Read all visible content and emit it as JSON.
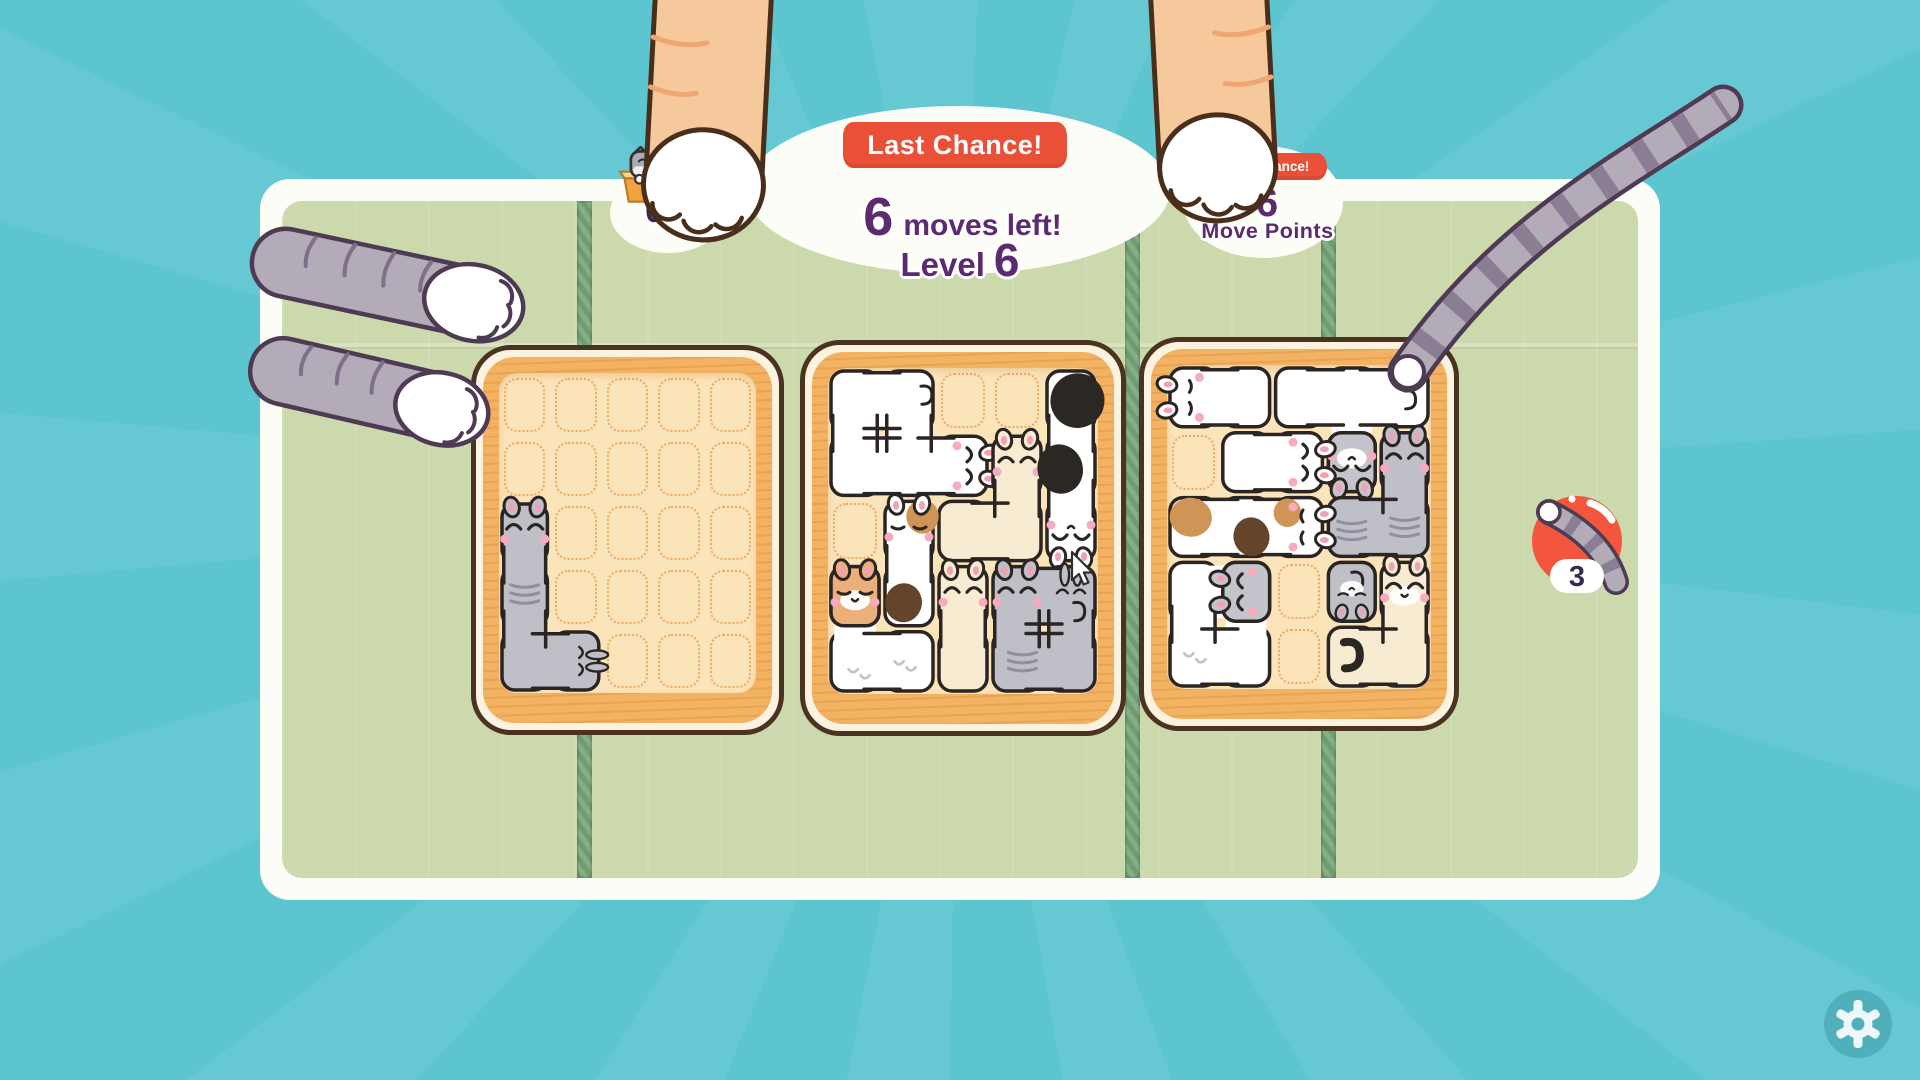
{
  "hud": {
    "boxed_cats": "0/4",
    "banner": "Last Chance!",
    "moves_number": "6",
    "moves_label": "moves left!",
    "level_label": "Level",
    "level_number": "6",
    "banner_right": "Last Chance!",
    "move_points_number": "6",
    "move_points_label": "Move Points",
    "booster_count": "3"
  },
  "palette": {
    "background_teal": "#5CC5CF",
    "panel_white": "#FDFDF7",
    "mat_green": "#CBD9AC",
    "seam_green": "#6F9C72",
    "basket_outline": "#4A3320",
    "basket_rim": "#F3B162",
    "basket_interior": "#FCE4BA",
    "grid_dots": "#ECA156",
    "ribbon_red": "#EA5038",
    "text_purple": "#5B2A70",
    "counter_navy": "#332C57",
    "ball_red": "#F2573D",
    "cat_gray": "#BFBFC7",
    "cat_cream": "#F7ECD2",
    "cat_white": "#FFFFFF",
    "cat_orange_head": "#EBAF79"
  },
  "board": {
    "grid": {
      "cols": 5,
      "rows": 5
    },
    "baskets": [
      {
        "name": "left",
        "x": 471,
        "y": 345,
        "w": 313,
        "h": 390,
        "pieces": [
          {
            "name": "gray-l-cat",
            "color": "gray",
            "cells": [
              [
                0,
                2
              ],
              [
                0,
                3
              ],
              [
                0,
                4
              ],
              [
                1,
                4
              ]
            ],
            "faces": [
              {
                "cell": [
                  0,
                  2
                ],
                "dir": "up",
                "style": "happy"
              },
              {
                "cell": [
                  1,
                  4
                ],
                "dir": "right",
                "style": "bunny",
                "small": true
              }
            ],
            "patches": [
              {
                "cell": [
                  0,
                  3
                ],
                "color": "stripes",
                "x": 0.5,
                "y": 0.45
              }
            ]
          }
        ]
      },
      {
        "name": "middle",
        "x": 800,
        "y": 340,
        "w": 326,
        "h": 396,
        "pieces": [
          {
            "name": "white-big-cat",
            "color": "white",
            "cells": [
              [
                0,
                0
              ],
              [
                1,
                0
              ],
              [
                0,
                1
              ],
              [
                1,
                1
              ],
              [
                2,
                1
              ]
            ],
            "faces": [
              {
                "cell": [
                  2,
                  1
                ],
                "dir": "right",
                "style": "happy"
              }
            ],
            "patches": [
              {
                "cell": [
                  1,
                  0
                ],
                "color": "curl",
                "x": 0.72,
                "y": 0.28
              }
            ]
          },
          {
            "name": "cream-s-cat",
            "color": "cream",
            "cells": [
              [
                3,
                1
              ],
              [
                2,
                2
              ],
              [
                3,
                2
              ]
            ],
            "faces": [
              {
                "cell": [
                  3,
                  1
                ],
                "dir": "up",
                "style": "happy"
              }
            ],
            "patches": []
          },
          {
            "name": "cow-cat",
            "color": "white",
            "cells": [
              [
                4,
                0
              ],
              [
                4,
                1
              ],
              [
                4,
                2
              ]
            ],
            "faces": [
              {
                "cell": [
                  4,
                  2
                ],
                "dir": "down",
                "style": "happy",
                "muzzle": true
              }
            ],
            "patches": [
              {
                "cell": [
                  4,
                  0
                ],
                "color": "black",
                "x": 0.62,
                "y": 0.5,
                "rx": 0.5,
                "ry": 0.42,
                "rot": 18
              },
              {
                "cell": [
                  4,
                  1
                ],
                "color": "black",
                "x": 0.3,
                "y": 0.55,
                "rx": 0.42,
                "ry": 0.38,
                "rot": -15
              }
            ]
          },
          {
            "name": "orange-head-cat",
            "color": "white",
            "headColor": "#EBAF79",
            "cells": [
              [
                0,
                3
              ],
              [
                0,
                4
              ],
              [
                1,
                4
              ]
            ],
            "faces": [
              {
                "cell": [
                  0,
                  3
                ],
                "dir": "up",
                "style": "sleep",
                "muzzle": true
              }
            ],
            "patches": [
              {
                "cell": [
                  1,
                  4
                ],
                "color": "print",
                "x": 0.4,
                "y": 0.5
              },
              {
                "cell": [
                  0,
                  4
                ],
                "color": "print",
                "x": 0.55,
                "y": 0.62
              }
            ]
          },
          {
            "name": "calico-cat",
            "color": "white",
            "cells": [
              [
                1,
                2
              ],
              [
                1,
                3
              ]
            ],
            "faces": [
              {
                "cell": [
                  1,
                  2
                ],
                "dir": "up",
                "style": "sleep"
              }
            ],
            "patches": [
              {
                "cell": [
                  1,
                  2
                ],
                "color": "orange",
                "x": 0.75,
                "y": 0.28,
                "rx": 0.3,
                "ry": 0.26,
                "rot": 0
              },
              {
                "cell": [
                  1,
                  3
                ],
                "color": "brown",
                "x": 0.4,
                "y": 0.6,
                "rx": 0.34,
                "ry": 0.3,
                "rot": 10
              }
            ]
          },
          {
            "name": "cream-tall-cat",
            "color": "cream",
            "cells": [
              [
                2,
                3
              ],
              [
                2,
                4
              ]
            ],
            "faces": [
              {
                "cell": [
                  2,
                  3
                ],
                "dir": "up",
                "style": "happy"
              }
            ],
            "patches": []
          },
          {
            "name": "gray-twin-cats",
            "color": "gray",
            "cells": [
              [
                3,
                3
              ],
              [
                4,
                3
              ],
              [
                3,
                4
              ],
              [
                4,
                4
              ]
            ],
            "faces": [
              {
                "cell": [
                  3,
                  3
                ],
                "dir": "up",
                "style": "happy"
              },
              {
                "cell": [
                  4,
                  3
                ],
                "dir": "up",
                "style": "bunny",
                "small": true
              }
            ],
            "patches": [
              {
                "cell": [
                  3,
                  4
                ],
                "color": "stripes",
                "x": 0.6,
                "y": 0.5
              },
              {
                "cell": [
                  4,
                  3
                ],
                "color": "curl",
                "x": 0.55,
                "y": 0.6
              }
            ]
          }
        ]
      },
      {
        "name": "right",
        "x": 1139,
        "y": 337,
        "w": 320,
        "h": 394,
        "pieces": [
          {
            "name": "white-loaf-cat",
            "color": "white",
            "cells": [
              [
                0,
                0
              ],
              [
                1,
                0
              ]
            ],
            "faces": [
              {
                "cell": [
                  0,
                  0
                ],
                "dir": "left",
                "style": "sleep"
              }
            ],
            "patches": []
          },
          {
            "name": "white-t-cat",
            "color": "white",
            "headColor": "#C4C4CC",
            "cells": [
              [
                2,
                0
              ],
              [
                3,
                0
              ],
              [
                4,
                0
              ],
              [
                3,
                1
              ]
            ],
            "faces": [
              {
                "cell": [
                  3,
                  1
                ],
                "dir": "down",
                "style": "happy",
                "muzzle": true
              }
            ],
            "patches": [
              {
                "cell": [
                  4,
                  0
                ],
                "color": "curl",
                "x": 0.5,
                "y": 0.4
              }
            ]
          },
          {
            "name": "white-mini-cat",
            "color": "white",
            "cells": [
              [
                1,
                1
              ],
              [
                2,
                1
              ]
            ],
            "faces": [
              {
                "cell": [
                  2,
                  1
                ],
                "dir": "right",
                "style": "happy"
              }
            ],
            "patches": []
          },
          {
            "name": "gray-corner-cat",
            "color": "gray",
            "cells": [
              [
                4,
                1
              ],
              [
                4,
                2
              ],
              [
                3,
                2
              ]
            ],
            "faces": [
              {
                "cell": [
                  4,
                  1
                ],
                "dir": "up",
                "style": "happy"
              }
            ],
            "patches": [
              {
                "cell": [
                  4,
                  2
                ],
                "color": "stripes",
                "x": 0.5,
                "y": 0.5
              },
              {
                "cell": [
                  3,
                  2
                ],
                "color": "stripes",
                "x": 0.5,
                "y": 0.55
              }
            ]
          },
          {
            "name": "calico-long-cat",
            "color": "white",
            "cells": [
              [
                0,
                2
              ],
              [
                1,
                2
              ],
              [
                2,
                2
              ]
            ],
            "faces": [
              {
                "cell": [
                  2,
                  2
                ],
                "dir": "right",
                "style": "sleep"
              }
            ],
            "patches": [
              {
                "cell": [
                  1,
                  2
                ],
                "color": "brown",
                "x": 0.6,
                "y": 0.65,
                "rx": 0.34,
                "ry": 0.3,
                "rot": -12
              },
              {
                "cell": [
                  0,
                  2
                ],
                "color": "orange",
                "x": 0.45,
                "y": 0.35,
                "rx": 0.4,
                "ry": 0.3,
                "rot": 8
              },
              {
                "cell": [
                  2,
                  2
                ],
                "color": "orange",
                "x": 0.28,
                "y": 0.28,
                "rx": 0.26,
                "ry": 0.22,
                "rot": 0
              }
            ]
          },
          {
            "name": "gray-kitten",
            "color": "gray",
            "cells": [
              [
                3,
                3
              ]
            ],
            "faces": [
              {
                "cell": [
                  3,
                  3
                ],
                "dir": "down",
                "style": "sleep",
                "muzzle": true,
                "small": true
              }
            ],
            "patches": [
              {
                "cell": [
                  3,
                  3
                ],
                "color": "curl",
                "x": 0.5,
                "y": 0.2
              }
            ]
          },
          {
            "name": "white-round-cat",
            "color": "white",
            "headColor": "#C4C4CC",
            "cells": [
              [
                0,
                3
              ],
              [
                1,
                3
              ],
              [
                0,
                4
              ],
              [
                1,
                4
              ]
            ],
            "faces": [
              {
                "cell": [
                  1,
                  3
                ],
                "dir": "left",
                "style": "happy"
              }
            ],
            "patches": [
              {
                "cell": [
                  0,
                  4
                ],
                "color": "print",
                "x": 0.5,
                "y": 0.45
              }
            ]
          },
          {
            "name": "cream-big-cat",
            "color": "cream",
            "cells": [
              [
                4,
                3
              ],
              [
                4,
                4
              ],
              [
                3,
                4
              ]
            ],
            "faces": [
              {
                "cell": [
                  4,
                  3
                ],
                "dir": "up",
                "style": "happy",
                "muzzle": true
              }
            ],
            "patches": [
              {
                "cell": [
                  3,
                  4
                ],
                "color": "tail",
                "x": 0.35,
                "y": 0.28
              }
            ]
          }
        ]
      }
    ]
  }
}
